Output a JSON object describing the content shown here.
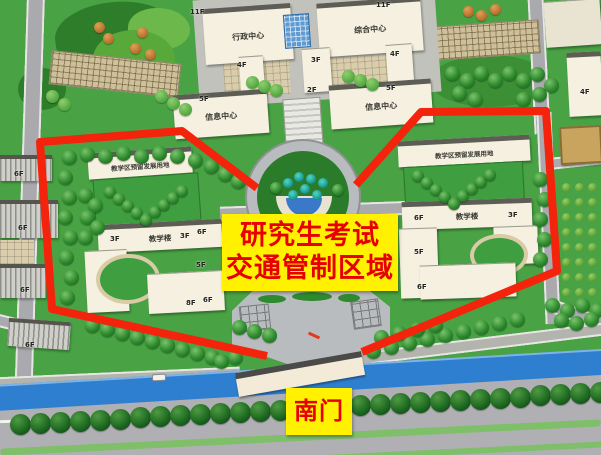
{
  "map": {
    "zone_box": {
      "line1": "研究生考试",
      "line2": "交通管制区域"
    },
    "south_gate_label": "南门",
    "buildings": {
      "admin_center": "行政中心",
      "general_center": "综合中心",
      "info_center_left": "信息中心",
      "info_center_right": "信息中心",
      "reserved_left": "教学区预留发展用地",
      "reserved_right": "教学区预留发展用地",
      "teaching_left": "教学楼",
      "teaching_right": "教学楼"
    },
    "floor_labels": [
      {
        "t": "11F",
        "x": 190,
        "y": 8
      },
      {
        "t": "11F",
        "x": 376,
        "y": 1
      },
      {
        "t": "4F",
        "x": 237,
        "y": 61
      },
      {
        "t": "3F",
        "x": 311,
        "y": 56
      },
      {
        "t": "4F",
        "x": 390,
        "y": 50
      },
      {
        "t": "5F",
        "x": 199,
        "y": 95
      },
      {
        "t": "2F",
        "x": 307,
        "y": 86
      },
      {
        "t": "5F",
        "x": 386,
        "y": 84
      },
      {
        "t": "3F",
        "x": 110,
        "y": 235
      },
      {
        "t": "3F",
        "x": 180,
        "y": 232
      },
      {
        "t": "6F",
        "x": 197,
        "y": 228
      },
      {
        "t": "5F",
        "x": 196,
        "y": 261
      },
      {
        "t": "8F",
        "x": 186,
        "y": 299
      },
      {
        "t": "6F",
        "x": 203,
        "y": 296
      },
      {
        "t": "6F",
        "x": 414,
        "y": 214
      },
      {
        "t": "3F",
        "x": 508,
        "y": 211
      },
      {
        "t": "5F",
        "x": 414,
        "y": 248
      },
      {
        "t": "6F",
        "x": 417,
        "y": 283
      },
      {
        "t": "6F",
        "x": 14,
        "y": 170
      },
      {
        "t": "6F",
        "x": 18,
        "y": 224
      },
      {
        "t": "6F",
        "x": 20,
        "y": 286
      },
      {
        "t": "6F",
        "x": 25,
        "y": 341
      },
      {
        "t": "4F",
        "x": 580,
        "y": 88
      }
    ],
    "colors": {
      "control_line": "#f3230c",
      "notice_bg": "#fff100",
      "notice_text": "#e60000",
      "canal": "#2e7fd0"
    }
  }
}
